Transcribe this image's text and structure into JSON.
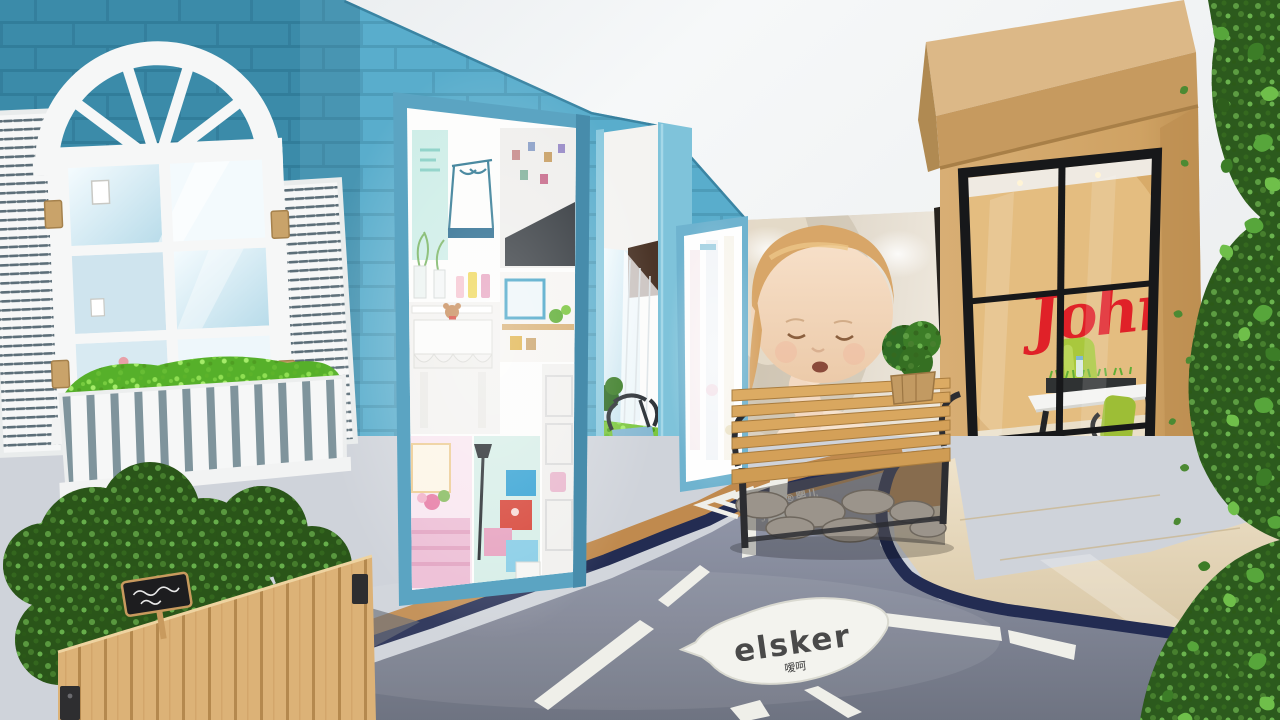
{
  "scene": {
    "description": "3D render of a baby-care retail store interior with blue brick facade, arched white window, lightbox photo displays, baby photo mural, wooden bench and a wooden Johnson's shop-in-shop with glass front; glossy grey road painted on the floor",
    "signs": {
      "leaf_logo": {
        "text": "elsker",
        "subtext": "嗳呵"
      },
      "floor_marking": {
        "line1": "强生®婴儿",
        "line2": "Johnson's baby"
      },
      "store_logo": {
        "text": "John"
      }
    },
    "colors": {
      "wall_blue": "#4ea7c7",
      "wall_blue_dark": "#2f7391",
      "lightbox_frame": "#5ba4c2",
      "wood_store": "#d2a86e",
      "logo_red": "#e02128",
      "road_grey": "#8d92a0",
      "road_navy": "#232c52",
      "marking_white": "#efefe9",
      "tile_tan": "#c08a4e",
      "tile_beige": "#e6d9bf",
      "plant_green_bright": "#56b02a",
      "plant_green_dark": "#2c5a1d",
      "bench_wood": "#d9a75f",
      "chair_green": "#a9c83d"
    }
  }
}
